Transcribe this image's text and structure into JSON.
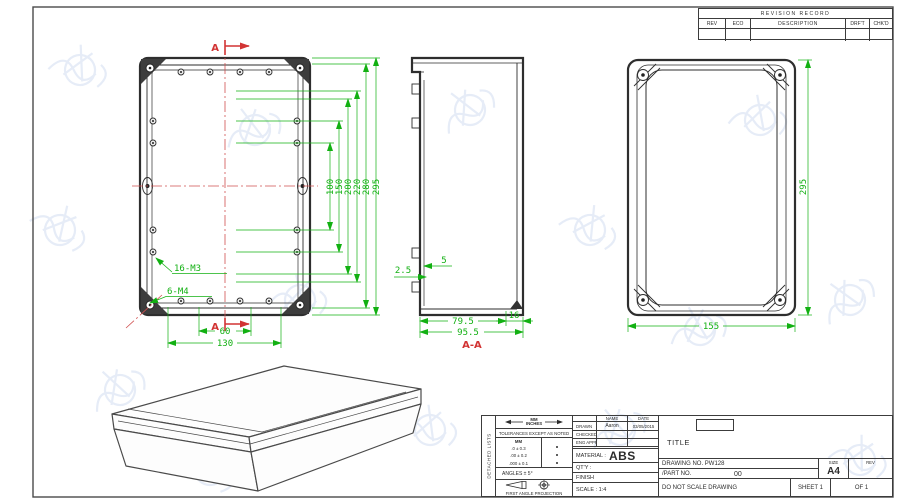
{
  "revision_record": {
    "title": "REVISION RECORD",
    "columns": [
      "REV",
      "ECO",
      "DESCRIPTION",
      "DRF'T",
      "CHK'D"
    ]
  },
  "plan_view": {
    "section_mark_top": "A",
    "section_mark_bottom": "A",
    "thread_note_m3": "16-M3",
    "thread_note_m4": "6-M4",
    "dims_vertical": [
      "100",
      "150",
      "200",
      "220",
      "280",
      "295"
    ],
    "dim_hole_spacing": "60",
    "dim_hole_span": "130"
  },
  "section_view": {
    "dim_wall": "2.5",
    "dim_rib": "5",
    "dim_depth_body": "79.5",
    "dim_lid": "16",
    "dim_depth_total": "95.5",
    "label": "A-A"
  },
  "back_view": {
    "dim_length": "295",
    "dim_width": "155"
  },
  "title_block": {
    "side_label": "DETACHED LISTS",
    "units_top": "MM",
    "units_bottom": "INCHES",
    "tolerance_note": "TOLERANCES EXCEPT AS NOTED",
    "tol_col_header": "MM",
    "tol_rows": [
      ".0 ± 0.3",
      ".00 ± 0.2",
      ".000 ± 0.1"
    ],
    "angles_note": "ANGLES ± 5°",
    "projection_note": "FIRST ANGLE PROJECTION",
    "name_header": "NAME",
    "date_header": "DATE",
    "drawn_label": "DRAWN",
    "drawn_name": "Aaron",
    "drawn_date": "03/05/2015",
    "checked_label": "CHECKED",
    "eng_appr_label": "ENG APPR",
    "material_label": "MATERIAL :",
    "material_value": "ABS",
    "qty_label": "QT'Y :",
    "finish_label": "FINISH",
    "scale_label": "SCALE : 1:4",
    "title_label": "TITLE",
    "drawing_no": "DRAWING NO. PW128",
    "part_no_label": "/PART NO.",
    "part_no_value": "00",
    "size_label": "SIZE",
    "size_value": "A4",
    "rev_label": "REV",
    "do_not_scale": "DO NOT SCALE DRAWING",
    "sheet_label": "SHEET 1",
    "of_label": "OF 1"
  }
}
